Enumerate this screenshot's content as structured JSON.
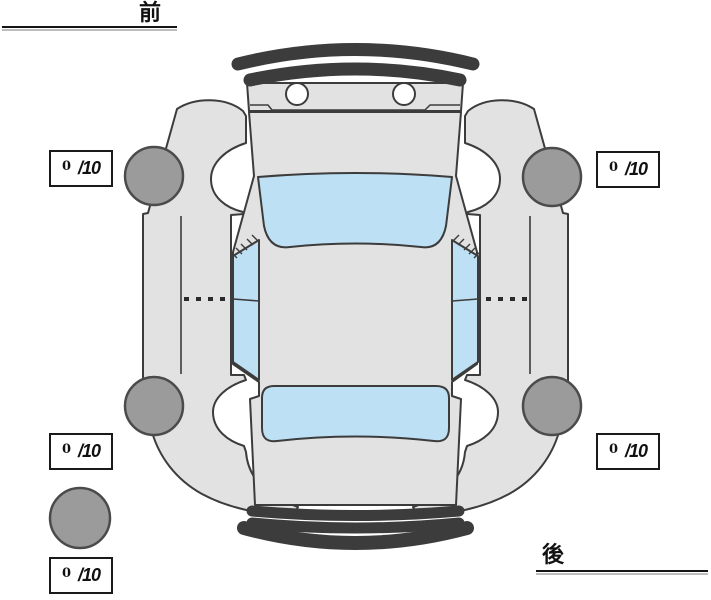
{
  "labels": {
    "front": "前",
    "rear": "後"
  },
  "scores": [
    {
      "id": "front-left",
      "value": "0",
      "max": "/10"
    },
    {
      "id": "front-right",
      "value": "0",
      "max": "/10"
    },
    {
      "id": "rear-left",
      "value": "0",
      "max": "/10"
    },
    {
      "id": "rear-right",
      "value": "0",
      "max": "/10"
    },
    {
      "id": "spare",
      "value": "0",
      "max": "/10"
    }
  ],
  "colors": {
    "background": "#ffffff",
    "car_body": "#e2e2e2",
    "car_outline": "#3c3c3c",
    "glass": "#bde0f5",
    "wheel_fill": "#9b9b9b",
    "wheel_outline": "#4b4b4b",
    "score_border": "#1a1a1a",
    "divider_line": "#151515"
  }
}
